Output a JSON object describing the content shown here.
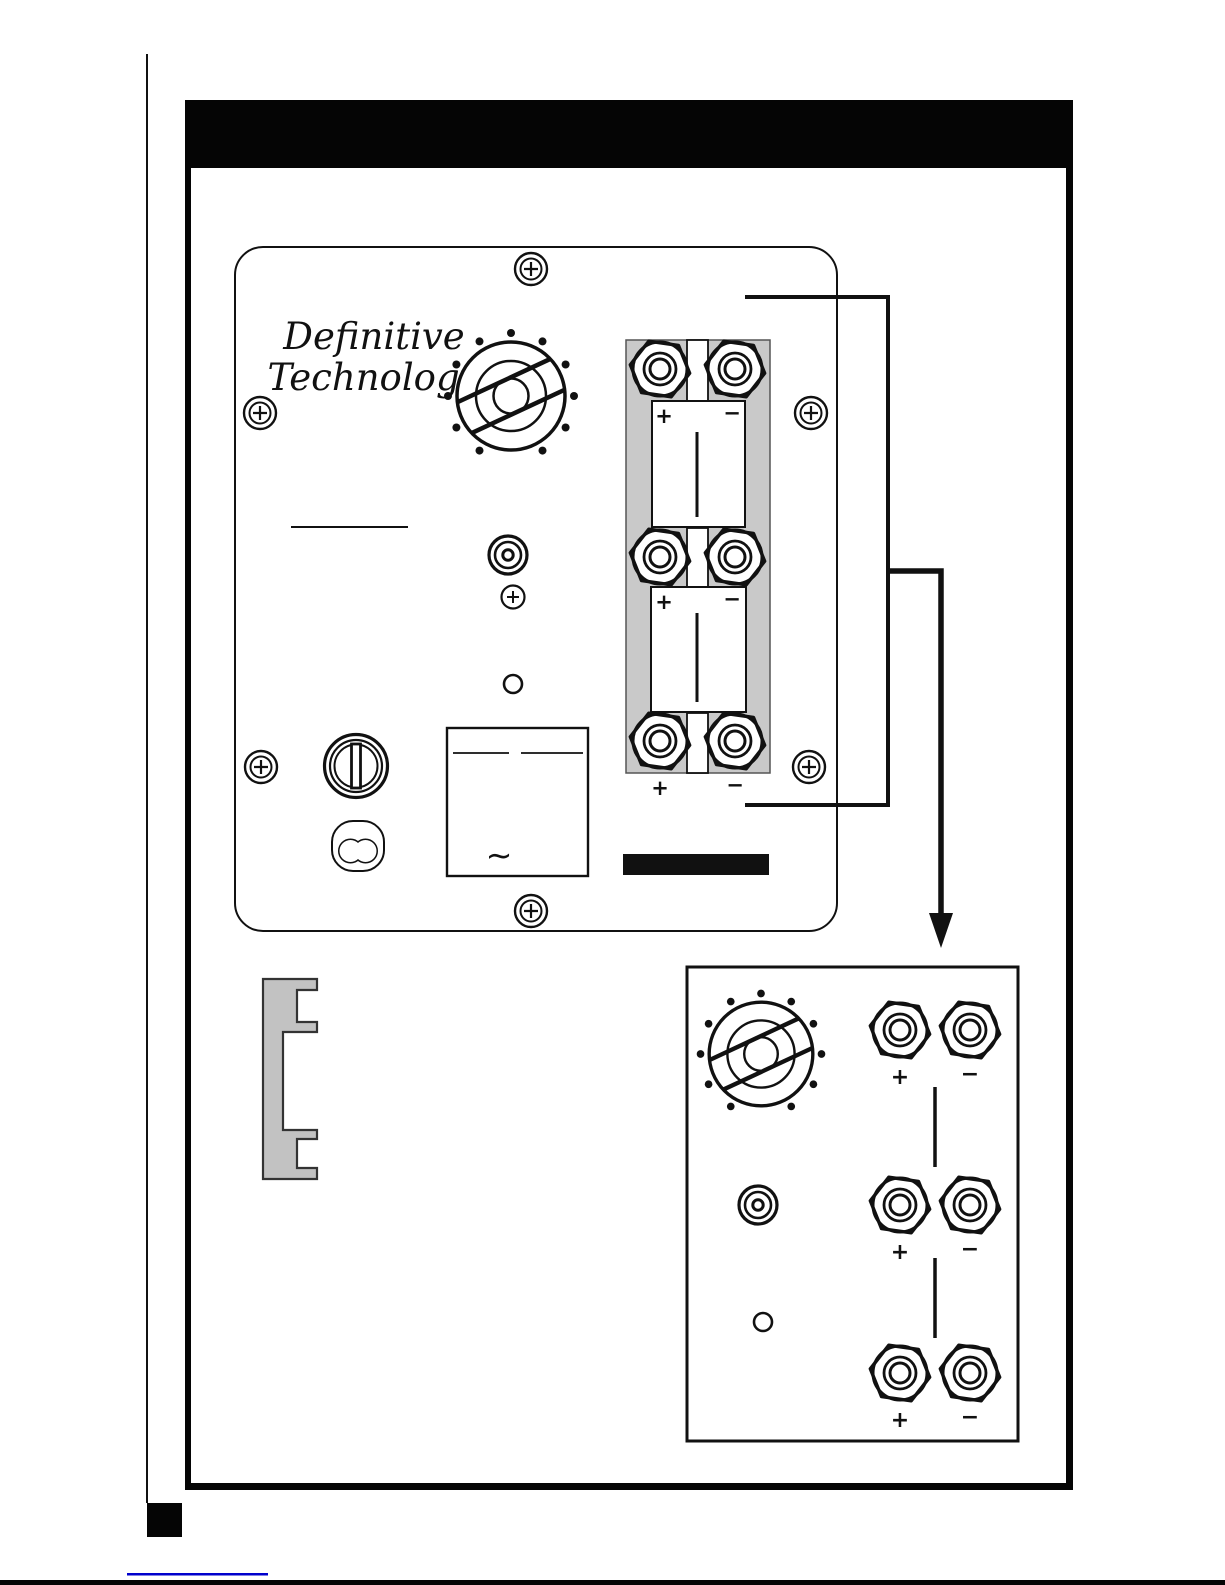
{
  "logo": {
    "line1": "Definitive",
    "line2": "Technology"
  },
  "labels": {
    "plus": "+",
    "minus": "−",
    "ac_tilde": "~"
  },
  "terminals": {
    "main_pairs": [
      {
        "plus": "+",
        "minus": "−"
      },
      {
        "plus": "+",
        "minus": "−"
      },
      {
        "plus": "+",
        "minus": "−"
      }
    ],
    "detail_pairs": [
      {
        "plus": "+",
        "minus": "−"
      },
      {
        "plus": "+",
        "minus": "−"
      },
      {
        "plus": "+",
        "minus": "−"
      }
    ]
  },
  "colors": {
    "ink": "#111111",
    "panel_gray": "#c9c9c9",
    "bracket_gray": "#c2c2c2",
    "link_blue": "#0000cc"
  }
}
